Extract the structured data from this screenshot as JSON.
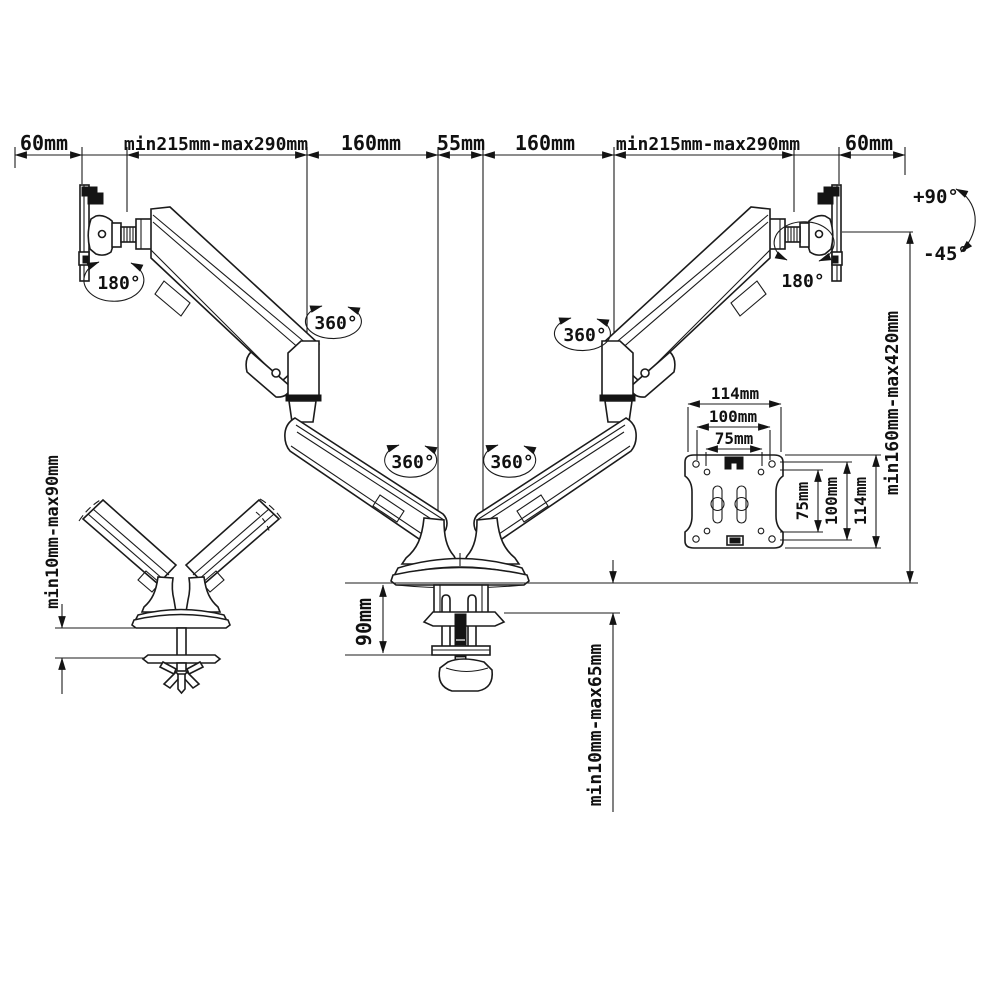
{
  "dims": {
    "top": [
      "60mm",
      "min215mm-max290mm",
      "160mm",
      "55mm",
      "160mm",
      "min215mm-max290mm",
      "60mm"
    ],
    "height_range": "min160mm-max420mm",
    "base_height": "90mm",
    "clamp_range": "min10mm-max65mm",
    "detail_clamp_range": "min10mm-max90mm",
    "vesa_width": [
      "114mm",
      "100mm",
      "75mm"
    ],
    "vesa_height": [
      "75mm",
      "100mm",
      "114mm"
    ]
  },
  "angles": {
    "swivel": "180°",
    "rotate": "360°",
    "tilt_up": "+90°",
    "tilt_down": "-45°"
  }
}
